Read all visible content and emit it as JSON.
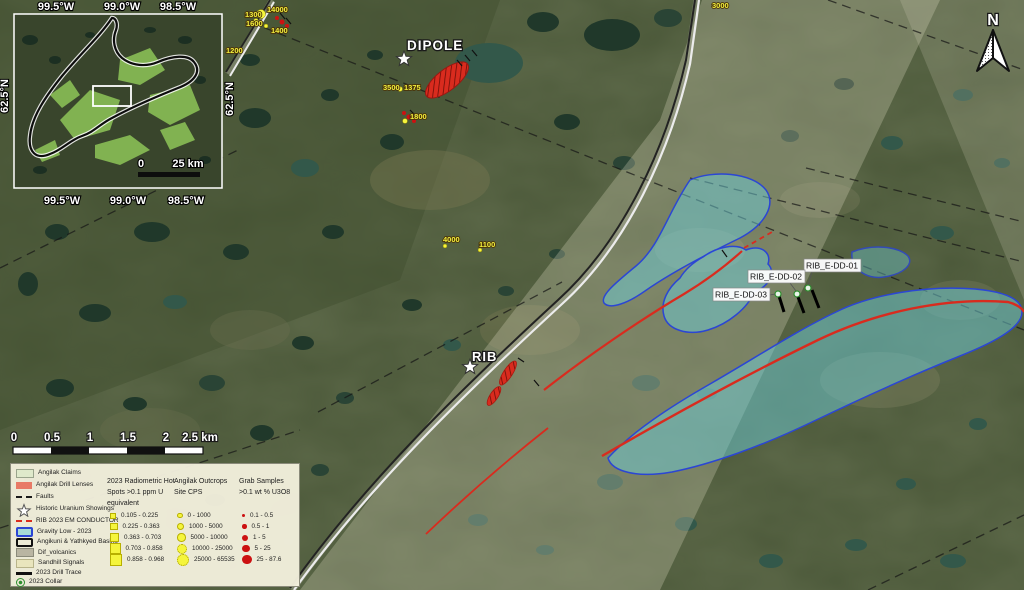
{
  "map": {
    "north_label": "N",
    "targets": {
      "dipole": "DIPOLE",
      "rib": "RIB"
    },
    "drill_holes": [
      "RIB_E-DD-01",
      "RIB_E-DD-02",
      "RIB_E-DD-03"
    ],
    "spot_labels": [
      "1300",
      "14000",
      "1600",
      "1400",
      "1200",
      "3000",
      "3500",
      "1375",
      "1800",
      "4000",
      "1100"
    ]
  },
  "inset": {
    "coords_top": [
      "99.5°W",
      "99.0°W",
      "98.5°W"
    ],
    "coords_bottom": [
      "99.5°W",
      "99.0°W",
      "98.5°W"
    ],
    "coord_left": "62.5°N",
    "coord_right": "62.5°N",
    "scale_start": "0",
    "scale_end": "25 km"
  },
  "scalebar": {
    "ticks": [
      "0",
      "0.5",
      "1",
      "1.5",
      "2",
      "2.5 km"
    ]
  },
  "legend": {
    "items": [
      {
        "label": "Angilak Claims"
      },
      {
        "label": "Angilak Drill Lenses"
      },
      {
        "label": "Faults"
      },
      {
        "label": "Historic Uranium Showings"
      },
      {
        "label": "RIB 2023 EM CONDUCTOR"
      },
      {
        "label": "Gravity Low - 2023"
      },
      {
        "label": "Angikuni & Yathkyed Basins"
      },
      {
        "label": "Dif_volcanics"
      },
      {
        "label": "Sandhill Signals"
      },
      {
        "label": "2023 Drill Trace"
      },
      {
        "label": "2023 Collar"
      }
    ],
    "radiometric": {
      "title_lines": [
        "2023 Radiometric Hot",
        "Spots >0.1 ppm U",
        "equivalent"
      ],
      "classes": [
        "0.105 - 0.225",
        "0.225 - 0.363",
        "0.363 - 0.703",
        "0.703 - 0.858",
        "0.858 - 0.968"
      ]
    },
    "cps": {
      "title_lines": [
        "Angilak Outcrops",
        "Site CPS"
      ],
      "classes": [
        "0 - 1000",
        "1000 - 5000",
        "5000 - 10000",
        "10000 - 25000",
        "25000 - 65535"
      ]
    },
    "grab": {
      "title_lines": [
        "Grab Samples",
        ">0.1 wt % U3O8"
      ],
      "classes": [
        "0.1 - 0.5",
        "0.5 - 1",
        "1 - 5",
        "5 - 25",
        "25 - 87.6"
      ]
    }
  },
  "colors": {
    "gravity_fill": "#6ecdd7",
    "gravity_stroke": "#2b46d4",
    "em_conductor_red": "#d92b1e",
    "radiometric_yellow": "#f5f53c",
    "grab_red": "#cc1111",
    "collar_green": "#2f8f2f",
    "claims_green": "#dfe9cb"
  }
}
